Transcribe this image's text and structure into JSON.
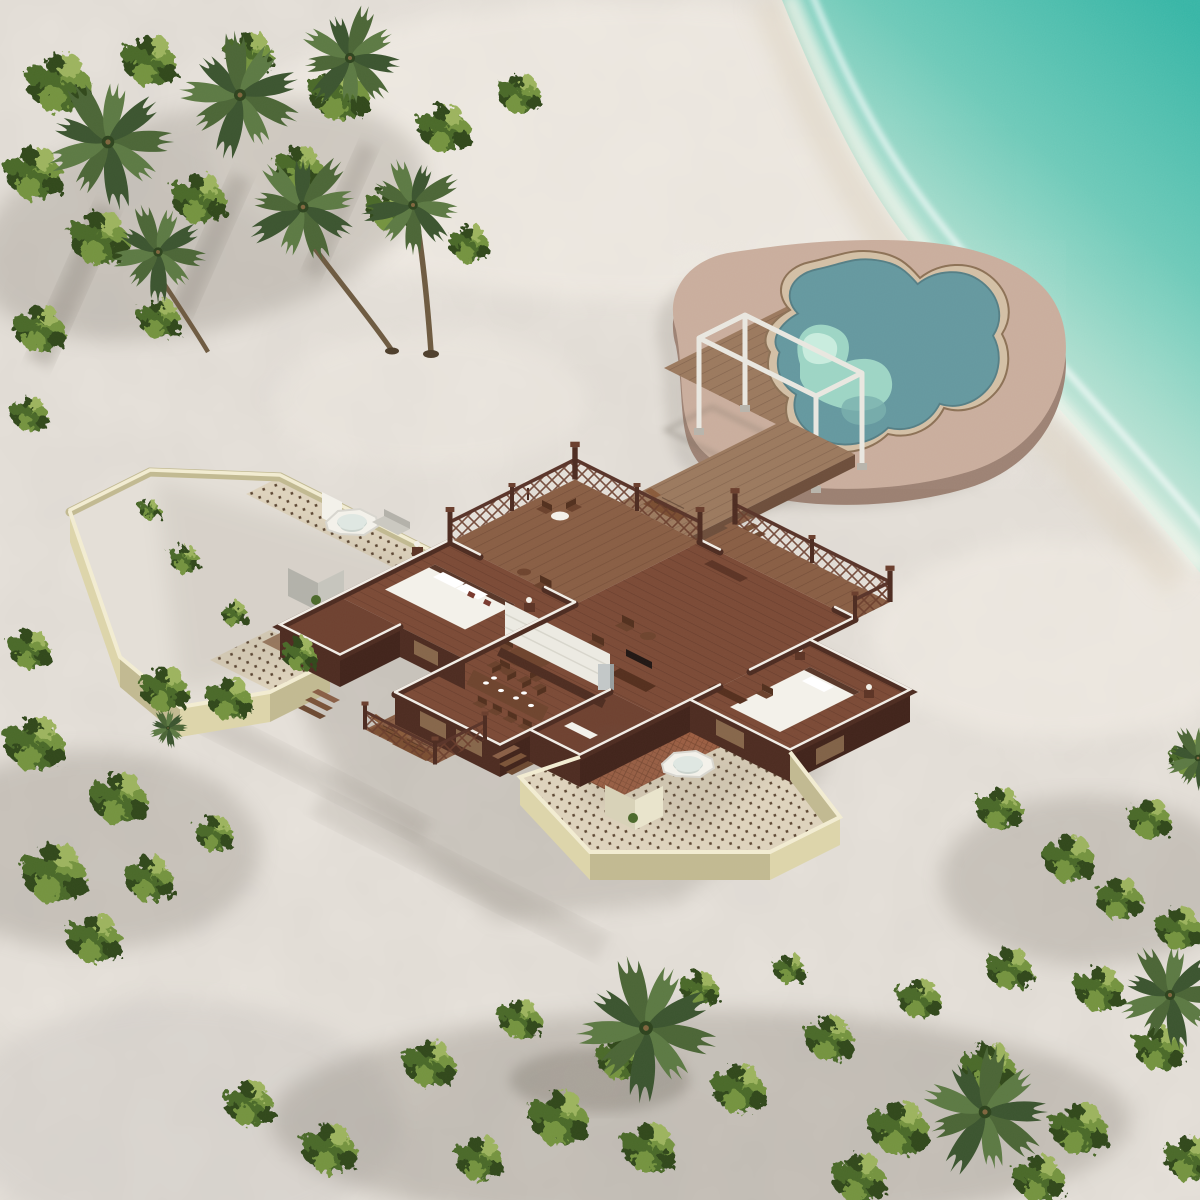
{
  "scene": {
    "kind": "aerial-3d-render",
    "subject": "tropical-beach-villa-floorplan",
    "environment": {
      "water": "turquoise-lagoon-top-right",
      "ground": "white-coral-sand",
      "vegetation": [
        "palm-cluster-top-left",
        "shrub-band-bottom",
        "shrub-cluster-right",
        "shrub-cluster-left-bottom"
      ]
    },
    "structures": {
      "pool_deck": {
        "shape": "organic-blob",
        "features": [
          "freeform-pool",
          "white-canopy-frame",
          "timber-sun-deck"
        ]
      },
      "jetty": {
        "connects": [
          "villa-terrace",
          "pool-deck"
        ],
        "features": [
          "side-steps",
          "lounge-chair"
        ]
      },
      "villa": {
        "rooms": [
          "master-bedroom",
          "living-room",
          "dining-kitchen",
          "second-bedroom",
          "bathroom-west",
          "bathroom-south"
        ],
        "outdoor": [
          "railed-terrace",
          "railed-veranda",
          "lounger-balcony",
          "walled-courtyard-west",
          "walled-courtyard-southeast"
        ],
        "furniture": [
          "double-bed-white",
          "second-bed-white",
          "long-dining-table-8-chairs",
          "round-table-5-chairs",
          "tv-console",
          "kitchen-counter",
          "steel-fridge",
          "outdoor-bathtub-west",
          "outdoor-bathtub-southeast",
          "shower-enclosures",
          "steamer-loungers"
        ]
      }
    },
    "lighting": {
      "sun_direction": "upper-right",
      "shadows": "cast-to-lower-left"
    }
  },
  "palette": {
    "sand": "#e7e2db",
    "sandBright": "#f4efe7",
    "sandShadow": "#c7c3bf",
    "oceanDeep": "#35b5a5",
    "oceanMid": "#6cc9b8",
    "oceanShallow": "#a5dccc",
    "foam": "#f2f7ee",
    "wetSand": "#dcd2c0",
    "deckTan": "#c9ad9c",
    "deckTanSide": "#9c8172",
    "poolRing": "#d3c0a6",
    "poolRimLine": "#8d7257",
    "poolDeep": "#6699a0",
    "poolMid": "#7ab0ae",
    "poolLight": "#a4dcc9",
    "poolPale": "#cdeee0",
    "woodJetty": "#9c7a5f",
    "woodJettyDark": "#85654c",
    "woodSide": "#6e4f3c",
    "terraceWood": "#8a5f45",
    "villaFloor": "#7c4b37",
    "villaFloorDark": "#6f4231",
    "wallDark": "#4e2d22",
    "wallMid": "#6b3f2e",
    "wallCap": "#f1ede6",
    "windowWood": "#8a6a4e",
    "creamTop": "#f2ecd2",
    "creamSide": "#ddd5ab",
    "creamSideDark": "#c2ba92",
    "tileBase": "#ded3bd",
    "tileDot": "#5c4632",
    "redTile": "#9e5f43",
    "whiteObj": "#f3f1ea",
    "whiteObjShade": "#d8d6cf",
    "grayObj": "#b3b2aa",
    "grayObjLight": "#c6c5bd",
    "steel": "#c3c8c8",
    "foliageDark": "#31491f",
    "foliage": "#4c6a2c",
    "foliageLight": "#74943f",
    "foliagePale": "#9db45f",
    "frond1": "#4c6637",
    "frond2": "#5d7a44",
    "frond3": "#3c5530",
    "trunk": "#6e5b41",
    "canopyWhite": "#e9e7e0",
    "shadow": "#6b6359"
  }
}
